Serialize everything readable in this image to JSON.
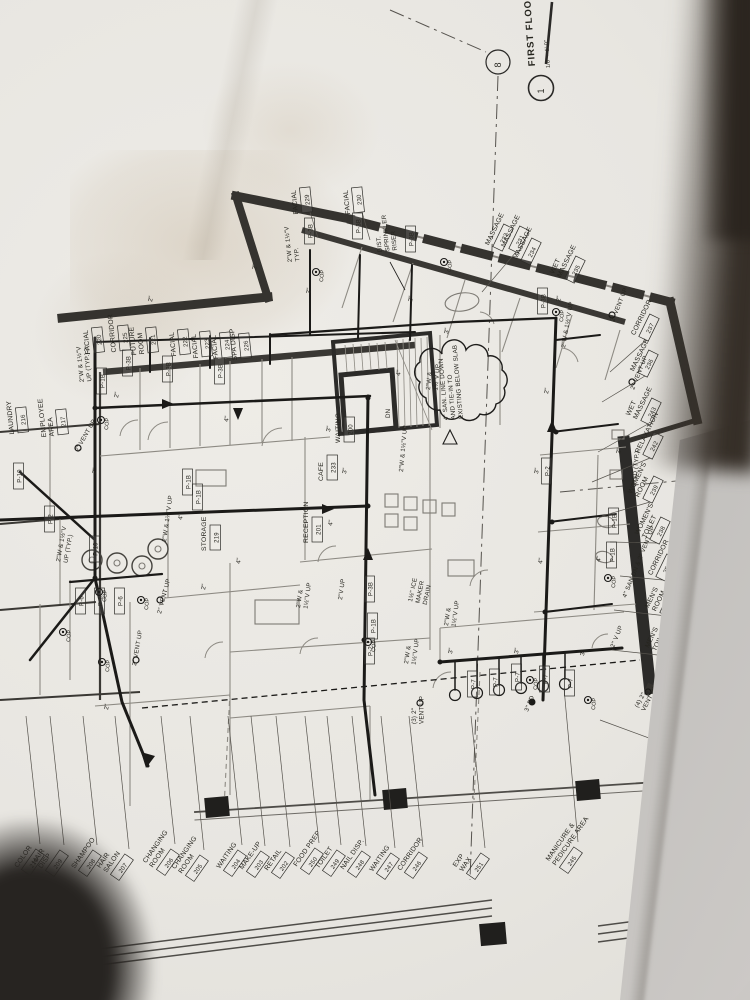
{
  "photo": {
    "paper_color": "#e9e7e2",
    "ink_color": "#2a2927",
    "wall_color": "#35332f",
    "shadow_color": "#2e2a25",
    "table_color": "#bdbbb8"
  },
  "titleblock": {
    "detail_number": "1",
    "title": "FIRST FLOOR  —",
    "scale": "1/8\" = 1'-0\"",
    "grid_bubble": "8"
  },
  "plan": {
    "bottom_rotation": -55,
    "rooms": [
      {
        "lines": [
          "FACIAL"
        ],
        "number": "220",
        "x": 102,
        "y": 352,
        "rot": -96
      },
      {
        "lines": [
          "CORRIDOR"
        ],
        "number": "225",
        "x": 128,
        "y": 350,
        "rot": -96
      },
      {
        "lines": [
          "FUTURE",
          "ROOM"
        ],
        "number": "221",
        "x": 156,
        "y": 352,
        "rot": -96
      },
      {
        "lines": [
          "FACIAL"
        ],
        "number": "222",
        "x": 188,
        "y": 354,
        "rot": -96
      },
      {
        "lines": [
          "FACIAL"
        ],
        "number": "223",
        "x": 210,
        "y": 356,
        "rot": -96
      },
      {
        "lines": [
          "FACIAL"
        ],
        "number": "224",
        "x": 230,
        "y": 357,
        "rot": -96
      },
      {
        "lines": [
          "SPA DISP"
        ],
        "number": "226",
        "x": 249,
        "y": 358,
        "rot": -96
      },
      {
        "lines": [
          "FACIAL"
        ],
        "number": "229",
        "x": 310,
        "y": 212,
        "rot": -96,
        "leader": [
          318,
          238
        ]
      },
      {
        "lines": [
          "FACIAL"
        ],
        "number": "230",
        "x": 362,
        "y": 212,
        "rot": -96,
        "leader": [
          370,
          240
        ]
      },
      {
        "lines": [
          "MASSAGE"
        ],
        "number": "231",
        "x": 516,
        "y": 252,
        "rot": -64,
        "leader": [
          482,
          292
        ]
      },
      {
        "lines": [
          "MASSAGE"
        ],
        "number": "232",
        "x": 500,
        "y": 250,
        "rot": -64
      },
      {
        "lines": [
          "MASSAGE"
        ],
        "number": "234",
        "x": 528,
        "y": 264,
        "rot": -64
      },
      {
        "lines": [
          "WET",
          "MASSAGE"
        ],
        "number": "235",
        "x": 572,
        "y": 282,
        "rot": -64
      },
      {
        "lines": [
          "CORRIDOR"
        ],
        "number": "237",
        "x": 646,
        "y": 340,
        "rot": -64,
        "leader": [
          610,
          372
        ]
      },
      {
        "lines": [
          "MASSAGE"
        ],
        "number": "236",
        "x": 645,
        "y": 376,
        "rot": -64,
        "leader": [
          602,
          402
        ]
      },
      {
        "lines": [
          "WET",
          "MASSAGE"
        ],
        "number": "243",
        "x": 648,
        "y": 424,
        "rot": -64,
        "leader": [
          598,
          452
        ]
      },
      {
        "lines": [
          "RELAXATION"
        ],
        "number": "242",
        "x": 650,
        "y": 458,
        "rot": -64,
        "leader": [
          592,
          482
        ]
      },
      {
        "lines": [
          "WOMEN'S",
          "ROOM"
        ],
        "number": "239",
        "x": 650,
        "y": 502,
        "rot": -64,
        "leader": [
          602,
          516
        ]
      },
      {
        "lines": [
          "WOMEN'S",
          "TOILET"
        ],
        "number": "238",
        "x": 657,
        "y": 543,
        "rot": -64,
        "leader": [
          610,
          542
        ]
      },
      {
        "lines": [
          "CORRIDOR"
        ],
        "number": "252",
        "x": 663,
        "y": 580,
        "rot": -64,
        "leader": [
          620,
          576
        ]
      },
      {
        "lines": [
          "MEN'S",
          "ROOM"
        ],
        "number": "240",
        "x": 667,
        "y": 616,
        "rot": -64,
        "leader": [
          614,
          610
        ]
      },
      {
        "lines": [
          "MEN'S",
          "TOILET"
        ],
        "number": "241",
        "x": 667,
        "y": 656,
        "rot": -64,
        "leader": [
          612,
          650
        ]
      },
      {
        "lines": [
          "PEDICURE"
        ],
        "number": "244",
        "x": 676,
        "y": 748,
        "rot": -64,
        "leader": [
          600,
          720
        ]
      },
      {
        "lines": [
          "LAUNDRY"
        ],
        "number": "216",
        "x": 26,
        "y": 432,
        "rot": -96
      },
      {
        "lines": [
          "EMPLOYEE",
          "AREA"
        ],
        "number": "217",
        "x": 66,
        "y": 434,
        "rot": -96
      },
      {
        "lines": [
          "STORAGE"
        ],
        "number": "219",
        "x": 218,
        "y": 550,
        "rot": -90
      },
      {
        "lines": [
          "WAITING"
        ],
        "number": "200",
        "x": 352,
        "y": 442,
        "rot": -90
      },
      {
        "lines": [
          "CAFE"
        ],
        "number": "233",
        "x": 335,
        "y": 480,
        "rot": -90
      },
      {
        "lines": [
          "RECEPTION"
        ],
        "number": "201",
        "x": 320,
        "y": 542,
        "rot": -90
      }
    ],
    "bottom_labels": [
      {
        "lines": [
          "COLOR"
        ],
        "number": "210",
        "x": 28,
        "y": 874
      },
      {
        "lines": [
          "HAIR",
          "DISP"
        ],
        "number": "209",
        "x": 52,
        "y": 875
      },
      {
        "lines": [
          "SHAMPOO"
        ],
        "number": "208",
        "x": 85,
        "y": 875
      },
      {
        "lines": [
          "HAIR",
          "SALON"
        ],
        "number": "207",
        "x": 117,
        "y": 879
      },
      {
        "lines": [
          "CHANGING",
          "ROOM"
        ],
        "number": "206",
        "x": 163,
        "y": 874
      },
      {
        "lines": [
          "CHANGING",
          "ROOM"
        ],
        "number": "205",
        "x": 192,
        "y": 880
      },
      {
        "lines": [
          "WAITING"
        ],
        "number": "204",
        "x": 230,
        "y": 875
      },
      {
        "lines": [
          "MAKE-UP"
        ],
        "number": "203",
        "x": 253,
        "y": 876
      },
      {
        "lines": [
          "RETAIL"
        ],
        "number": "202",
        "x": 278,
        "y": 877
      },
      {
        "lines": [
          "FOOD PREP"
        ],
        "number": "250",
        "x": 307,
        "y": 873
      },
      {
        "lines": [
          "TOILET"
        ],
        "number": "249",
        "x": 329,
        "y": 875
      },
      {
        "lines": [
          "NAIL DISP."
        ],
        "number": "248",
        "x": 354,
        "y": 876
      },
      {
        "lines": [
          "WAITING"
        ],
        "number": "247",
        "x": 383,
        "y": 878
      },
      {
        "lines": [
          "CORRIDOR"
        ],
        "number": "246",
        "x": 411,
        "y": 877
      },
      {
        "lines": [
          "EXP",
          "WAX"
        ],
        "number": "251",
        "x": 473,
        "y": 878
      },
      {
        "lines": [
          "MANICURE &",
          "PEDICURE AREA"
        ],
        "number": "245",
        "x": 566,
        "y": 872,
        "leader_to_y": 688
      }
    ],
    "notes": [
      {
        "lines": [
          "2\"W & 1½\"V",
          "UP (TYP.)"
        ],
        "x": 84,
        "y": 382,
        "rot": -96
      },
      {
        "lines": [
          "2\"W & 1½\"V",
          "TYP."
        ],
        "x": 292,
        "y": 262,
        "rot": -96
      },
      {
        "lines": [
          "DIST.",
          "SPRINKLER",
          "RISER"
        ],
        "x": 382,
        "y": 252,
        "rot": -96
      },
      {
        "lines": [
          "2\" VENT UP"
        ],
        "x": 614,
        "y": 322,
        "rot": -68
      },
      {
        "lines": [
          "2\" VENT UP"
        ],
        "x": 634,
        "y": 390,
        "rot": -68
      },
      {
        "lines": [
          "4\" SAN DN & 2\" VENT UP"
        ],
        "x": 626,
        "y": 598,
        "rot": -68
      },
      {
        "lines": [
          "2\" V UP"
        ],
        "x": 614,
        "y": 648,
        "rot": -68
      },
      {
        "lines": [
          "(4) 2\"",
          "VENT UP"
        ],
        "x": 638,
        "y": 708,
        "rot": -62
      },
      {
        "lines": [
          "(3) 2\"",
          "VENT UP"
        ],
        "x": 416,
        "y": 724,
        "rot": -90
      },
      {
        "lines": [
          "3\" FD"
        ],
        "x": 528,
        "y": 712,
        "rot": -68
      },
      {
        "lines": [
          "2\"SD (TYP.)"
        ],
        "x": 636,
        "y": 486,
        "rot": -85
      },
      {
        "lines": [
          "1½\" ICE",
          "MAKER",
          "DRAIN"
        ],
        "x": 412,
        "y": 602,
        "rot": -78
      },
      {
        "lines": [
          "2\"W &",
          "1½\"V UP"
        ],
        "x": 300,
        "y": 608,
        "rot": -82
      },
      {
        "lines": [
          "2\"V UP"
        ],
        "x": 342,
        "y": 600,
        "rot": -82
      },
      {
        "lines": [
          "2\"W &",
          "1½\"V UP"
        ],
        "x": 408,
        "y": 664,
        "rot": -82
      },
      {
        "lines": [
          "2\"W &",
          "1½\"V UP"
        ],
        "x": 448,
        "y": 626,
        "rot": -82
      },
      {
        "lines": [
          "2\"W & 1½\"V",
          "UP (TYP.)"
        ],
        "x": 60,
        "y": 562,
        "rot": -80
      },
      {
        "lines": [
          "2\" VENT UP"
        ],
        "x": 161,
        "y": 614,
        "rot": -75
      },
      {
        "lines": [
          "2\" VENT UP"
        ],
        "x": 136,
        "y": 666,
        "rot": -80
      },
      {
        "lines": [
          "2\"W & 1½\"V UP"
        ],
        "x": 403,
        "y": 472,
        "rot": -85
      },
      {
        "lines": [
          "2\"W & 1½\"V UP"
        ],
        "x": 166,
        "y": 542,
        "rot": -82
      },
      {
        "lines": [
          "2\" VENT UP"
        ],
        "x": 78,
        "y": 452,
        "rot": -60
      },
      {
        "lines": [
          "2\"W & 1½\"V UP"
        ],
        "x": 565,
        "y": 348,
        "rot": -80
      },
      {
        "lines": [
          "DN"
        ],
        "x": 390,
        "y": 418,
        "rot": -90
      },
      {
        "lines": [
          "4\" SAN. LINE DOWN",
          "AND TIE-IN TO",
          "EXISTING BELOW SLAB"
        ],
        "x": 448,
        "y": 420,
        "rot": -95
      },
      {
        "lines": [
          "2\"W &",
          "1½\"V UP"
        ],
        "x": 430,
        "y": 390,
        "rot": -85
      }
    ],
    "fixtures": [
      {
        "t": "P-1B",
        "x": 104,
        "y": 392
      },
      {
        "t": "P-3B",
        "x": 130,
        "y": 374
      },
      {
        "t": "P-3B",
        "x": 170,
        "y": 380
      },
      {
        "t": "P-3B",
        "x": 222,
        "y": 382
      },
      {
        "t": "P-3B",
        "x": 312,
        "y": 242
      },
      {
        "t": "P-3B",
        "x": 360,
        "y": 237
      },
      {
        "t": "P-3B",
        "x": 413,
        "y": 250
      },
      {
        "t": "P-3B",
        "x": 545,
        "y": 312
      },
      {
        "t": "P-1B",
        "x": 200,
        "y": 508
      },
      {
        "t": "P-1B",
        "x": 616,
        "y": 532
      },
      {
        "t": "P-1B",
        "x": 614,
        "y": 566
      },
      {
        "t": "P-2",
        "x": 549,
        "y": 482
      },
      {
        "t": "P-2",
        "x": 372,
        "y": 662
      },
      {
        "t": "P-1B",
        "x": 375,
        "y": 637
      },
      {
        "t": "P-3B",
        "x": 372,
        "y": 600
      },
      {
        "t": "P-6",
        "x": 83,
        "y": 612
      },
      {
        "t": "P-6",
        "x": 102,
        "y": 612
      },
      {
        "t": "P-6",
        "x": 122,
        "y": 612
      },
      {
        "t": "P-7",
        "x": 475,
        "y": 695
      },
      {
        "t": "P-7",
        "x": 497,
        "y": 693
      },
      {
        "t": "P-7",
        "x": 519,
        "y": 688
      },
      {
        "t": "P-7",
        "x": 547,
        "y": 690
      },
      {
        "t": "P-7",
        "x": 572,
        "y": 694
      },
      {
        "t": "P-10",
        "x": 97,
        "y": 560
      },
      {
        "t": "P-10",
        "x": 21,
        "y": 487
      },
      {
        "t": "P-2",
        "x": 52,
        "y": 530
      },
      {
        "t": "P-1B",
        "x": 190,
        "y": 493
      }
    ],
    "pipe_sizes": [
      {
        "t": "2\"",
        "x": 118,
        "y": 398
      },
      {
        "t": "2\"",
        "x": 152,
        "y": 302
      },
      {
        "t": "2\"",
        "x": 256,
        "y": 270
      },
      {
        "t": "2\"",
        "x": 310,
        "y": 294
      },
      {
        "t": "2\"",
        "x": 412,
        "y": 302
      },
      {
        "t": "3\"",
        "x": 330,
        "y": 432
      },
      {
        "t": "4\"",
        "x": 400,
        "y": 376
      },
      {
        "t": "3\"",
        "x": 346,
        "y": 474
      },
      {
        "t": "4\"",
        "x": 332,
        "y": 526
      },
      {
        "t": "2\"",
        "x": 548,
        "y": 394
      },
      {
        "t": "3\"",
        "x": 538,
        "y": 474
      },
      {
        "t": "4\"",
        "x": 542,
        "y": 564
      },
      {
        "t": "3\"",
        "x": 452,
        "y": 654
      },
      {
        "t": "3\"",
        "x": 518,
        "y": 654
      },
      {
        "t": "2\"",
        "x": 96,
        "y": 474
      },
      {
        "t": "4\"",
        "x": 240,
        "y": 564
      },
      {
        "t": "2\"",
        "x": 108,
        "y": 710
      },
      {
        "t": "3\"",
        "x": 584,
        "y": 656
      },
      {
        "t": "4\"",
        "x": 228,
        "y": 422
      },
      {
        "t": "2\"",
        "x": 560,
        "y": 302
      },
      {
        "t": "3\"",
        "x": 448,
        "y": 334
      },
      {
        "t": "2\"",
        "x": 620,
        "y": 454
      },
      {
        "t": "4\"",
        "x": 600,
        "y": 562
      },
      {
        "t": "2\"",
        "x": 205,
        "y": 590
      },
      {
        "t": "4\"",
        "x": 182,
        "y": 520
      },
      {
        "t": "2\"",
        "x": 88,
        "y": 352
      }
    ],
    "cop_label": "COP",
    "cops": [
      {
        "x": 101,
        "y": 420
      },
      {
        "x": 99,
        "y": 592
      },
      {
        "x": 63,
        "y": 632
      },
      {
        "x": 141,
        "y": 600
      },
      {
        "x": 316,
        "y": 272
      },
      {
        "x": 444,
        "y": 262
      },
      {
        "x": 556,
        "y": 312
      },
      {
        "x": 608,
        "y": 578
      },
      {
        "x": 530,
        "y": 680
      },
      {
        "x": 368,
        "y": 642
      },
      {
        "x": 588,
        "y": 700
      },
      {
        "x": 102,
        "y": 662
      }
    ]
  }
}
